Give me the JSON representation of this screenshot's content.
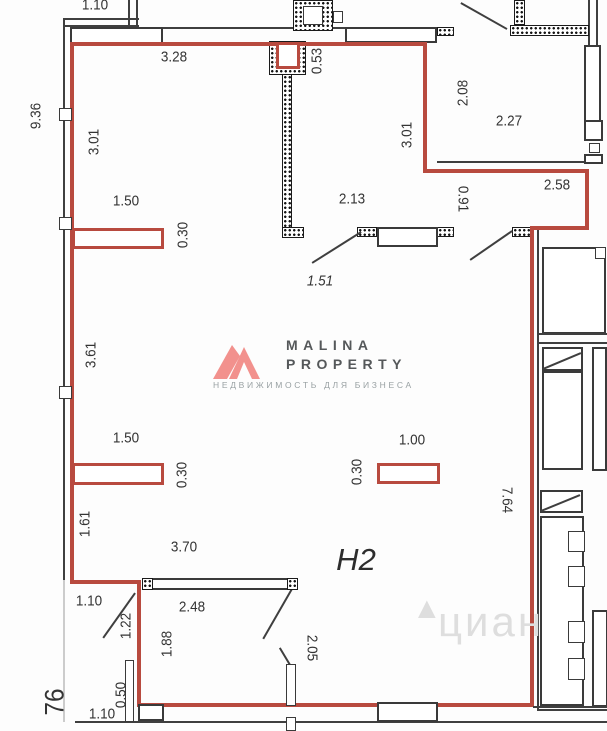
{
  "plan": {
    "unit_label": "H2"
  },
  "colors": {
    "red": "#b84a3f",
    "pink": "#f2918d",
    "wm": "#dedede"
  },
  "logo": {
    "line1": "MALINA",
    "line2": "PROPERTY",
    "tagline": "НЕДВИЖИМОСТЬ ДЛЯ БИЗНЕСА"
  },
  "watermark": {
    "text": "циан"
  },
  "dimensions": [
    {
      "t": "1.10",
      "x": 95,
      "y": 5,
      "r": 0
    },
    {
      "t": "9.36",
      "x": 36,
      "y": 116,
      "r": -90
    },
    {
      "t": "3.28",
      "x": 174,
      "y": 57,
      "r": 0
    },
    {
      "t": "0.53",
      "x": 317,
      "y": 61,
      "r": -90
    },
    {
      "t": "3.01",
      "x": 94,
      "y": 142,
      "r": -90
    },
    {
      "t": "3.01",
      "x": 407,
      "y": 135,
      "r": -90
    },
    {
      "t": "2.08",
      "x": 463,
      "y": 93,
      "r": -90
    },
    {
      "t": "2.27",
      "x": 509,
      "y": 121,
      "r": 0
    },
    {
      "t": "2.58",
      "x": 557,
      "y": 185,
      "r": 0
    },
    {
      "t": "1.50",
      "x": 126,
      "y": 201,
      "r": 0
    },
    {
      "t": "0.30",
      "x": 183,
      "y": 235,
      "r": -90
    },
    {
      "t": "2.13",
      "x": 352,
      "y": 199,
      "r": 0
    },
    {
      "t": "0.91",
      "x": 463,
      "y": 199,
      "r": 90
    },
    {
      "t": "1.51",
      "x": 320,
      "y": 281,
      "r": 0,
      "it": true
    },
    {
      "t": "3.61",
      "x": 91,
      "y": 355,
      "r": -90
    },
    {
      "t": "1.50",
      "x": 126,
      "y": 438,
      "r": 0
    },
    {
      "t": "0.30",
      "x": 182,
      "y": 475,
      "r": -90
    },
    {
      "t": "1.00",
      "x": 412,
      "y": 440,
      "r": 0
    },
    {
      "t": "0.30",
      "x": 357,
      "y": 472,
      "r": -90
    },
    {
      "t": "7.64",
      "x": 507,
      "y": 500,
      "r": 90
    },
    {
      "t": "1.61",
      "x": 85,
      "y": 524,
      "r": -90
    },
    {
      "t": "3.70",
      "x": 184,
      "y": 547,
      "r": 0
    },
    {
      "t": "1.10",
      "x": 89,
      "y": 601,
      "r": 0
    },
    {
      "t": "1.22",
      "x": 126,
      "y": 626,
      "r": -90
    },
    {
      "t": "2.48",
      "x": 192,
      "y": 607,
      "r": 0
    },
    {
      "t": "1.88",
      "x": 167,
      "y": 644,
      "r": -90
    },
    {
      "t": "2.05",
      "x": 312,
      "y": 648,
      "r": 90
    },
    {
      "t": "0.50",
      "x": 121,
      "y": 695,
      "r": -90
    },
    {
      "t": "1.10",
      "x": 102,
      "y": 714,
      "r": 0
    },
    {
      "t": "76",
      "x": 55,
      "y": 702,
      "r": -90,
      "fs": 27
    }
  ]
}
